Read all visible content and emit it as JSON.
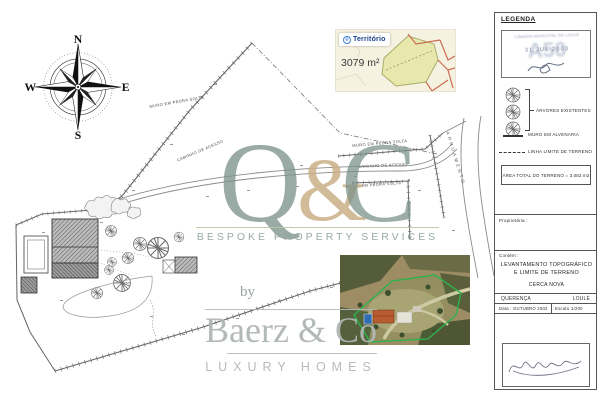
{
  "compass": {
    "north": "N",
    "east": "E",
    "south": "S",
    "west": "W"
  },
  "inset_map": {
    "logo_prefix": "e",
    "logo_name": "Território",
    "area_label": "3079 m²"
  },
  "plan": {
    "labels": [
      {
        "text": "MURO EM PEDRA SOLTA"
      },
      {
        "text": "CAMINHO DE ACESSO"
      },
      {
        "text": "MURO EM PEDRA SOLTA"
      },
      {
        "text": "CAMINHO DE ACESSO"
      },
      {
        "text": "MURO EM PEDRA SOLTA"
      },
      {
        "text": "ARRUAMENTO"
      }
    ]
  },
  "watermark": {
    "q": "Q",
    "amp": "&",
    "c": "C",
    "tagline": "BESPOKE PROPERTY SERVICES",
    "by": "by",
    "brand": "Baerz & Co",
    "sub": "LUXURY HOMES",
    "sage": "#7C938B",
    "gold": "#C9AF86",
    "gray": "#B0B6B4"
  },
  "legend": {
    "title": "LEGENDA",
    "stamp": {
      "authority": "CÂMARA MUNICIPAL DE LOULÉ",
      "ghost": "A50",
      "date": "31 JUL 2003"
    },
    "items": {
      "trees": "ÁRVORES EXISTENTES",
      "wall": "MURO EM ALVENARIA",
      "limit": "LINHA LIMITE DE TERRENO"
    },
    "area_total": "ÁREA TOTAL DO TERRENO = 3.083 m2",
    "owner_label": "Proprietária :",
    "contains_label": "Contém :",
    "doc_title_1": "LEVANTAMENTO TOPOGRÁFICO",
    "doc_title_2": "E LIMITE DE TERRENO",
    "doc_subtitle": "CERCA NOVA",
    "parish": "QUERENÇA",
    "municipality": "LOULÉ",
    "date_label": "Data :",
    "date_value": "OUTUBRO 2002",
    "scale_label": "Escala :",
    "scale_value": "1/200"
  }
}
